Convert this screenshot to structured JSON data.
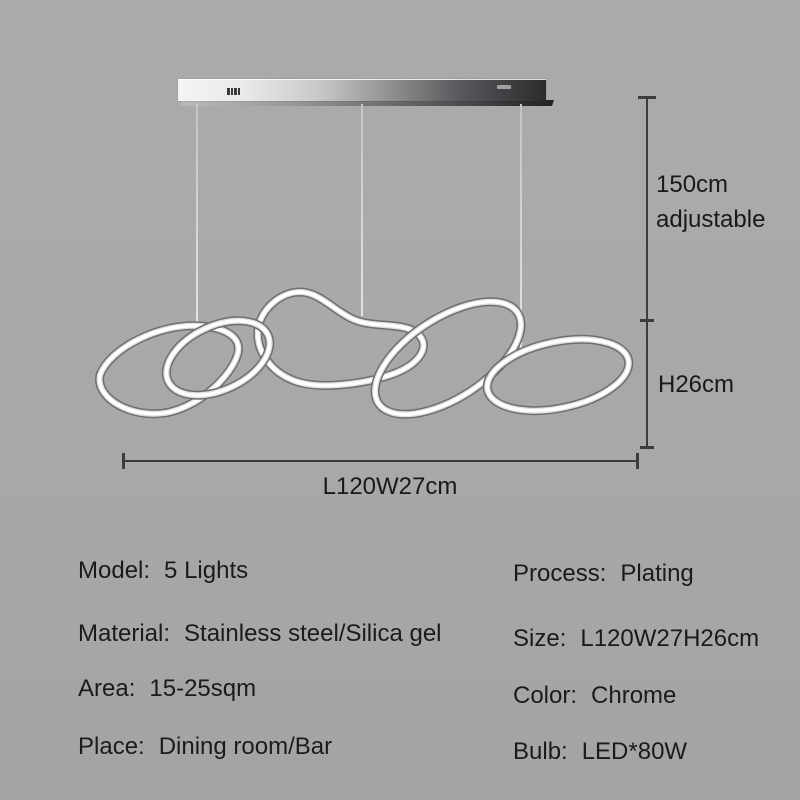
{
  "annotations": {
    "drop_height_line1": "150cm",
    "drop_height_line2": "adjustable",
    "fixture_height": "H26cm",
    "fixture_width": "L120W27cm"
  },
  "specs": {
    "left": [
      {
        "label": "Model:",
        "value": "5 Lights"
      },
      {
        "label": "Material:",
        "value": "Stainless steel/Silica gel"
      },
      {
        "label": "Area:",
        "value": "15-25sqm"
      },
      {
        "label": "Place:",
        "value": "Dining room/Bar"
      }
    ],
    "right": [
      {
        "label": "Process:",
        "value": "Plating"
      },
      {
        "label": "Size:",
        "value": "L120W27H26cm"
      },
      {
        "label": "Color:",
        "value": "Chrome"
      },
      {
        "label": "Bulb:",
        "value": "LED*80W"
      }
    ]
  },
  "colors": {
    "background": "#a8a8a8",
    "text": "#1b1b1b",
    "dimension_line": "#3c3c3c",
    "chrome_dark": "#707070",
    "chrome_light": "#ffffff",
    "canopy_dark_end": "#2c2c2e"
  },
  "icons": {
    "brand_mark_left": "barcode-mark",
    "brand_mark_right": "label-mark"
  }
}
